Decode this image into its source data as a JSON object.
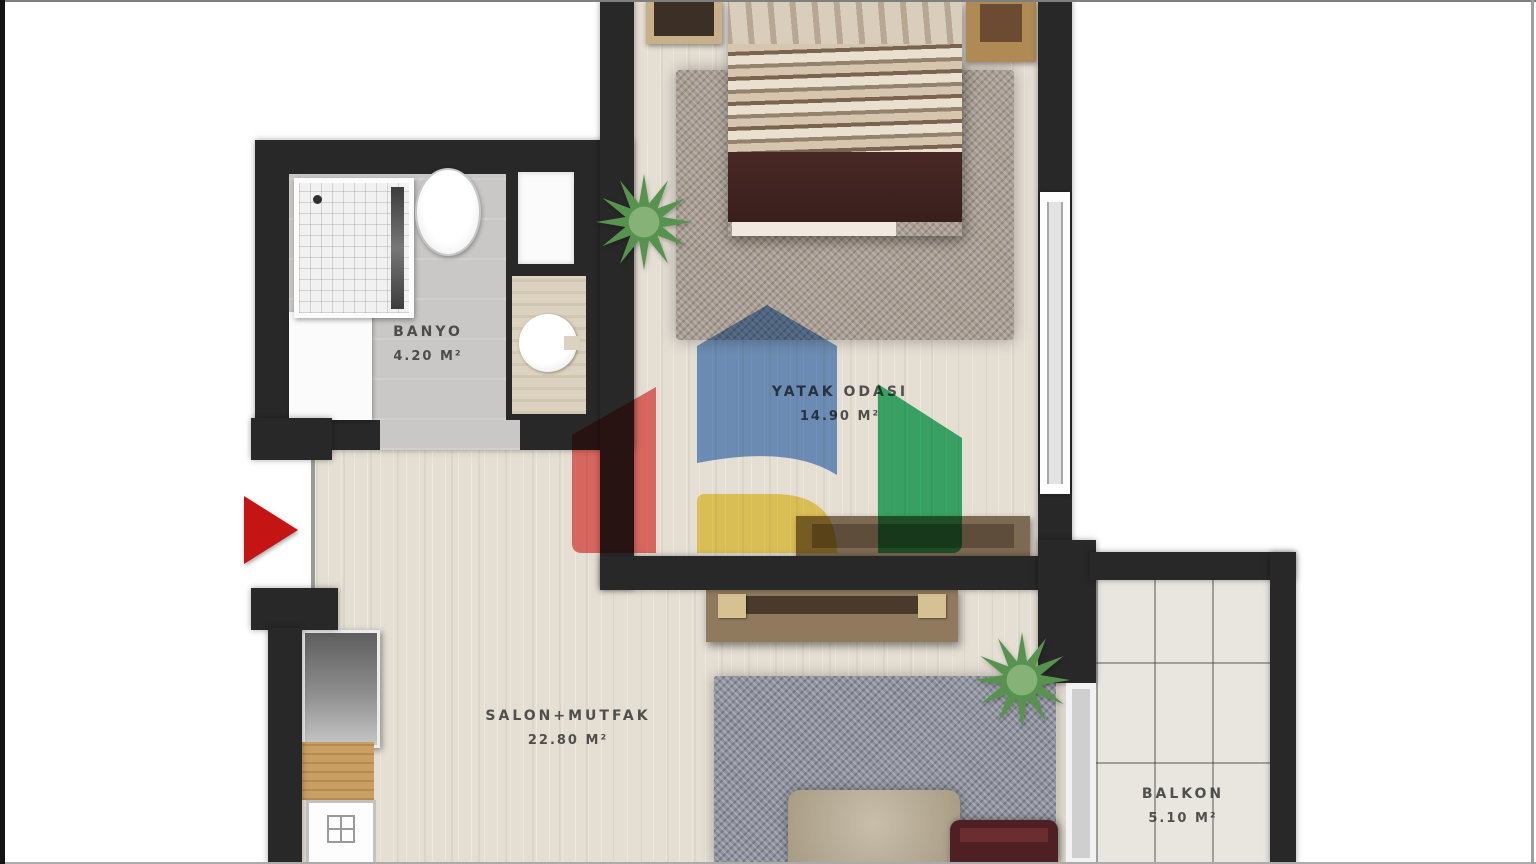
{
  "plan": {
    "title": "apartment-floor-plan",
    "rooms": [
      {
        "id": "banyo",
        "label": "BANYO",
        "area": "4.20 M²"
      },
      {
        "id": "yatak-odasi",
        "label": "YATAK ODASI",
        "area": "14.90 M²"
      },
      {
        "id": "salon-mutfak",
        "label": "SALON+MUTFAK",
        "area": "22.80 M²"
      },
      {
        "id": "balkon",
        "label": "BALKON",
        "area": "5.10 M²"
      }
    ],
    "colors": {
      "wall": "#282828",
      "wood_floor": "#e4ded3",
      "bath_floor": "#c9c8c6",
      "balcony_floor": "#e9e6e0",
      "bedroom_rug": "#a79d92",
      "salon_rug": "#8e929c",
      "entrance_arrow": "#c41414",
      "label_text": "#3c3c3c"
    }
  },
  "watermark": {
    "logo_colors": {
      "red": "#ef6a66",
      "blue": "#6f99d4",
      "yellow": "#f2d75c",
      "green": "#2eb36c"
    }
  }
}
